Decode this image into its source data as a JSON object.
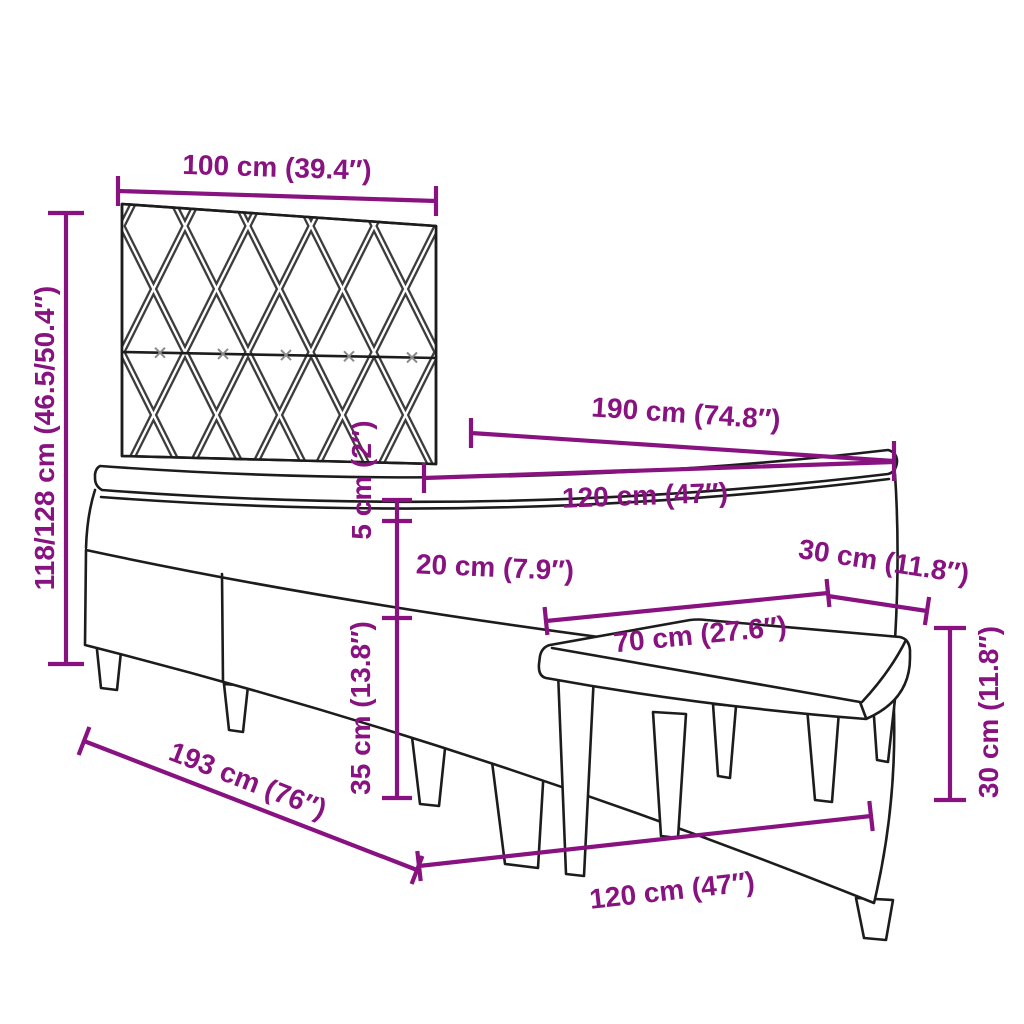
{
  "diagram": {
    "background": "#ffffff",
    "colors": {
      "dimension": "#871280",
      "outline": "#1c1c1c",
      "pattern": "#3d3d3d",
      "tuft": "#8a8a8a"
    },
    "product": "Box spring bed with patterned headboard, mattress, topper and bench",
    "dimensions": {
      "headboard_width": "100 cm (39.4″)",
      "total_height": "118/128 cm (46.5/50.4″)",
      "bed_length": "190 cm (74.8″)",
      "mattress_width": "120 cm (47″)",
      "topper_thickness": "5 cm (2″)",
      "mattress_thickness": "20 cm (7.9″)",
      "base_height": "35 cm (13.8″)",
      "frame_length": "193 cm (76″)",
      "frame_width": "120 cm (47″)",
      "bench_length": "70 cm (27.6″)",
      "bench_depth": "30 cm (11.8″)",
      "bench_height": "30 cm (11.8″)"
    }
  }
}
